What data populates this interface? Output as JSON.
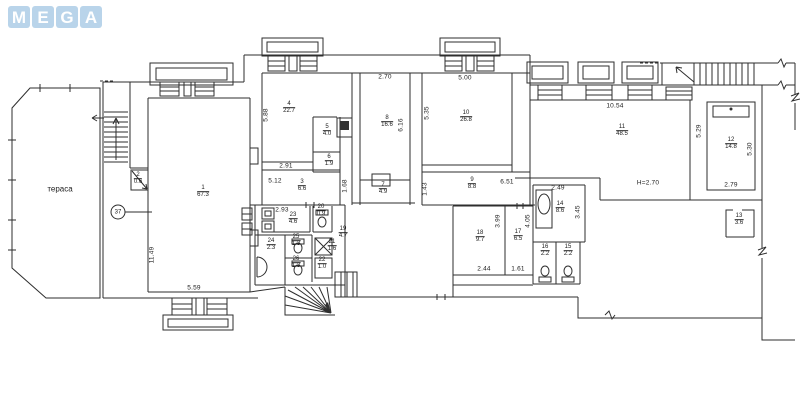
{
  "logo": {
    "letters": [
      "M",
      "E",
      "G",
      "A"
    ],
    "tile_color": "#b9d4ea",
    "letter_color": "#ffffff"
  },
  "plan": {
    "line_color": "#2e2e2e",
    "terrace": {
      "label": "тераса",
      "x": 60,
      "y": 189
    },
    "marker": {
      "label": "37",
      "x": 118,
      "y": 212
    },
    "height_note": "H=2.70",
    "rooms": [
      {
        "num": "1",
        "area": "67.3",
        "x": 203,
        "y": 192
      },
      {
        "num": "2",
        "area": "0.6",
        "x": 138,
        "y": 179
      },
      {
        "num": "3",
        "area": "6.6",
        "x": 302,
        "y": 186
      },
      {
        "num": "4",
        "area": "22.7",
        "x": 289,
        "y": 108
      },
      {
        "num": "5",
        "area": "4.0",
        "x": 327,
        "y": 131
      },
      {
        "num": "6",
        "area": "1.9",
        "x": 329,
        "y": 161
      },
      {
        "num": "7",
        "area": "4.9",
        "x": 383,
        "y": 189
      },
      {
        "num": "8",
        "area": "16.6",
        "x": 387,
        "y": 122
      },
      {
        "num": "9",
        "area": "8.8",
        "x": 472,
        "y": 184
      },
      {
        "num": "10",
        "area": "26.8",
        "x": 466,
        "y": 117
      },
      {
        "num": "11",
        "area": "48.5",
        "x": 622,
        "y": 131
      },
      {
        "num": "12",
        "area": "14.8",
        "x": 731,
        "y": 144
      },
      {
        "num": "13",
        "area": "3.6",
        "x": 739,
        "y": 220
      },
      {
        "num": "14",
        "area": "8.6",
        "x": 560,
        "y": 208
      },
      {
        "num": "15",
        "area": "2.2",
        "x": 568,
        "y": 251
      },
      {
        "num": "16",
        "area": "2.2",
        "x": 545,
        "y": 251
      },
      {
        "num": "17",
        "area": "6.5",
        "x": 518,
        "y": 236
      },
      {
        "num": "18",
        "area": "9.7",
        "x": 480,
        "y": 237
      },
      {
        "num": "19",
        "area": "4.7",
        "x": 343,
        "y": 233
      },
      {
        "num": "20",
        "area": "0.9",
        "x": 321,
        "y": 211
      },
      {
        "num": "21",
        "area": "1.6",
        "x": 332,
        "y": 246
      },
      {
        "num": "22",
        "area": "1.0",
        "x": 322,
        "y": 264
      },
      {
        "num": "23",
        "area": "4.6",
        "x": 293,
        "y": 219
      },
      {
        "num": "24",
        "area": "2.3",
        "x": 271,
        "y": 245
      },
      {
        "num": "25",
        "area": "1.3",
        "x": 296,
        "y": 241
      },
      {
        "num": "26",
        "area": "1.3",
        "x": 296,
        "y": 263
      }
    ],
    "dimensions": [
      {
        "text": "5.88",
        "x": 266,
        "y": 115,
        "rot": true
      },
      {
        "text": "2.91",
        "x": 286,
        "y": 166
      },
      {
        "text": "5.12",
        "x": 275,
        "y": 181
      },
      {
        "text": "2.93",
        "x": 282,
        "y": 210
      },
      {
        "text": "11.49",
        "x": 152,
        "y": 255,
        "rot": true
      },
      {
        "text": "5.59",
        "x": 194,
        "y": 288
      },
      {
        "text": "2.70",
        "x": 385,
        "y": 77
      },
      {
        "text": "6.16",
        "x": 401,
        "y": 125,
        "rot": true
      },
      {
        "text": "5.35",
        "x": 427,
        "y": 113,
        "rot": true
      },
      {
        "text": "5.00",
        "x": 465,
        "y": 78
      },
      {
        "text": "1.68",
        "x": 345,
        "y": 186,
        "rot": true
      },
      {
        "text": "1.43",
        "x": 425,
        "y": 189,
        "rot": true
      },
      {
        "text": "6.51",
        "x": 507,
        "y": 182
      },
      {
        "text": "2.49",
        "x": 558,
        "y": 188
      },
      {
        "text": "3.45",
        "x": 578,
        "y": 212,
        "rot": true
      },
      {
        "text": "3.99",
        "x": 498,
        "y": 221,
        "rot": true
      },
      {
        "text": "4.05",
        "x": 528,
        "y": 221,
        "rot": true
      },
      {
        "text": "2.44",
        "x": 484,
        "y": 269
      },
      {
        "text": "1.61",
        "x": 518,
        "y": 269
      },
      {
        "text": "10.54",
        "x": 615,
        "y": 106
      },
      {
        "text": "H=2.70",
        "x": 648,
        "y": 183
      },
      {
        "text": "5.29",
        "x": 699,
        "y": 131,
        "rot": true
      },
      {
        "text": "5.30",
        "x": 750,
        "y": 149,
        "rot": true
      },
      {
        "text": "2.79",
        "x": 731,
        "y": 185
      }
    ]
  }
}
